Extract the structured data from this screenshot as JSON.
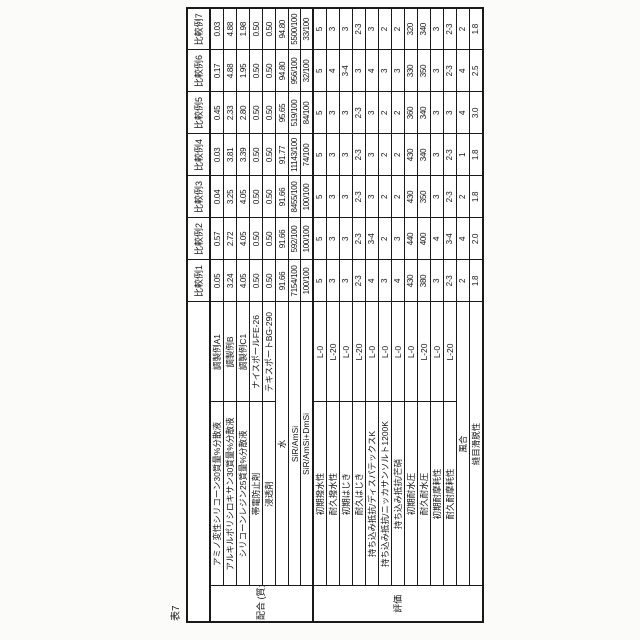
{
  "caption": "表7",
  "columns": [
    "比較例1",
    "比較例2",
    "比較例3",
    "比較例4",
    "比較例5",
    "比較例6",
    "比較例7"
  ],
  "groups": [
    {
      "label": "配合\n(質量部)",
      "rows": [
        {
          "name": "アミノ変性シリコーン30質量%分散液",
          "sub": "調製例A1",
          "values": [
            "0.05",
            "0.57",
            "0.04",
            "0.03",
            "0.45",
            "0.17",
            "0.03"
          ]
        },
        {
          "name": "アルキルポリシロキサン30質量%分散液",
          "sub": "調製例B",
          "values": [
            "3.24",
            "2.72",
            "3.25",
            "3.81",
            "2.33",
            "4.88",
            "4.88"
          ]
        },
        {
          "name": "シリコーンレジン25質量%分散液",
          "sub": "調製例C1",
          "values": [
            "4.05",
            "4.05",
            "4.05",
            "3.39",
            "2.80",
            "1.95",
            "1.98"
          ]
        },
        {
          "name": "帯電防止剤",
          "sub": "ナイスポールFE-26",
          "values": [
            "0.50",
            "0.50",
            "0.50",
            "0.50",
            "0.50",
            "0.50",
            "0.50"
          ]
        },
        {
          "name": "浸透剤",
          "sub": "テキスポートBG-290",
          "values": [
            "0.50",
            "0.50",
            "0.50",
            "0.50",
            "0.50",
            "0.50",
            "0.50"
          ]
        },
        {
          "name": "水",
          "sub": null,
          "values": [
            "91.66",
            "91.66",
            "91.66",
            "91.77",
            "95.65",
            "94.80",
            "94.80"
          ]
        },
        {
          "name": "SiR/AmSi",
          "sub": null,
          "values": [
            "7154/100",
            "592/100",
            "8455/100",
            "11143/100",
            "519/100",
            "956/100",
            "5500/100"
          ]
        },
        {
          "name": "SiR/AmSi+DmSi",
          "sub": null,
          "values": [
            "100/100",
            "100/100",
            "100/100",
            "74/100",
            "84/100",
            "32/100",
            "33/100"
          ]
        }
      ]
    },
    {
      "label": "評価",
      "rows": [
        {
          "name": "初期撥水性",
          "sub": "L-0",
          "values": [
            "5",
            "5",
            "5",
            "5",
            "5",
            "5",
            "5"
          ]
        },
        {
          "name": "耐久撥水性",
          "sub": "L-20",
          "values": [
            "3",
            "3",
            "3",
            "3",
            "3",
            "4",
            "3"
          ]
        },
        {
          "name": "初期はじき",
          "sub": "L-0",
          "values": [
            "3",
            "3",
            "3",
            "3",
            "3",
            "3-4",
            "3"
          ]
        },
        {
          "name": "耐久はじき",
          "sub": "L-20",
          "values": [
            "2-3",
            "2-3",
            "2-3",
            "2-3",
            "2-3",
            "3",
            "2-3"
          ]
        },
        {
          "name": "持ち込み抵抗/ディスパテックスK",
          "sub": "L-0",
          "values": [
            "4",
            "3-4",
            "3",
            "3",
            "3",
            "4",
            "3"
          ]
        },
        {
          "name": "持ち込み抵抗/ニッカサンソルト1200K",
          "sub": "L-0",
          "values": [
            "3",
            "2",
            "2",
            "2",
            "2",
            "3",
            "2"
          ]
        },
        {
          "name": "持ち込み抵抗/芒硝",
          "sub": "L-0",
          "values": [
            "4",
            "3",
            "2",
            "2",
            "2",
            "3",
            "2"
          ]
        },
        {
          "name": "初期耐水圧",
          "sub": "L-0",
          "values": [
            "430",
            "440",
            "430",
            "430",
            "360",
            "330",
            "320"
          ]
        },
        {
          "name": "耐久耐水圧",
          "sub": "L-20",
          "values": [
            "380",
            "400",
            "350",
            "340",
            "340",
            "350",
            "340"
          ]
        },
        {
          "name": "初期耐摩耗性",
          "sub": "L-0",
          "values": [
            "3",
            "4",
            "3",
            "3",
            "3",
            "3",
            "3"
          ]
        },
        {
          "name": "耐久耐摩耗性",
          "sub": "L-20",
          "values": [
            "2-3",
            "3-4",
            "2-3",
            "2-3",
            "3",
            "2-3",
            "2-3"
          ]
        },
        {
          "name": "風合",
          "sub": null,
          "values": [
            "2",
            "4",
            "2",
            "1",
            "4",
            "4",
            "2"
          ]
        },
        {
          "name": "縫目滑脱性",
          "sub": null,
          "values": [
            "1.8",
            "2.0",
            "1.8",
            "1.8",
            "3.0",
            "2.5",
            "1.8"
          ]
        }
      ]
    }
  ]
}
